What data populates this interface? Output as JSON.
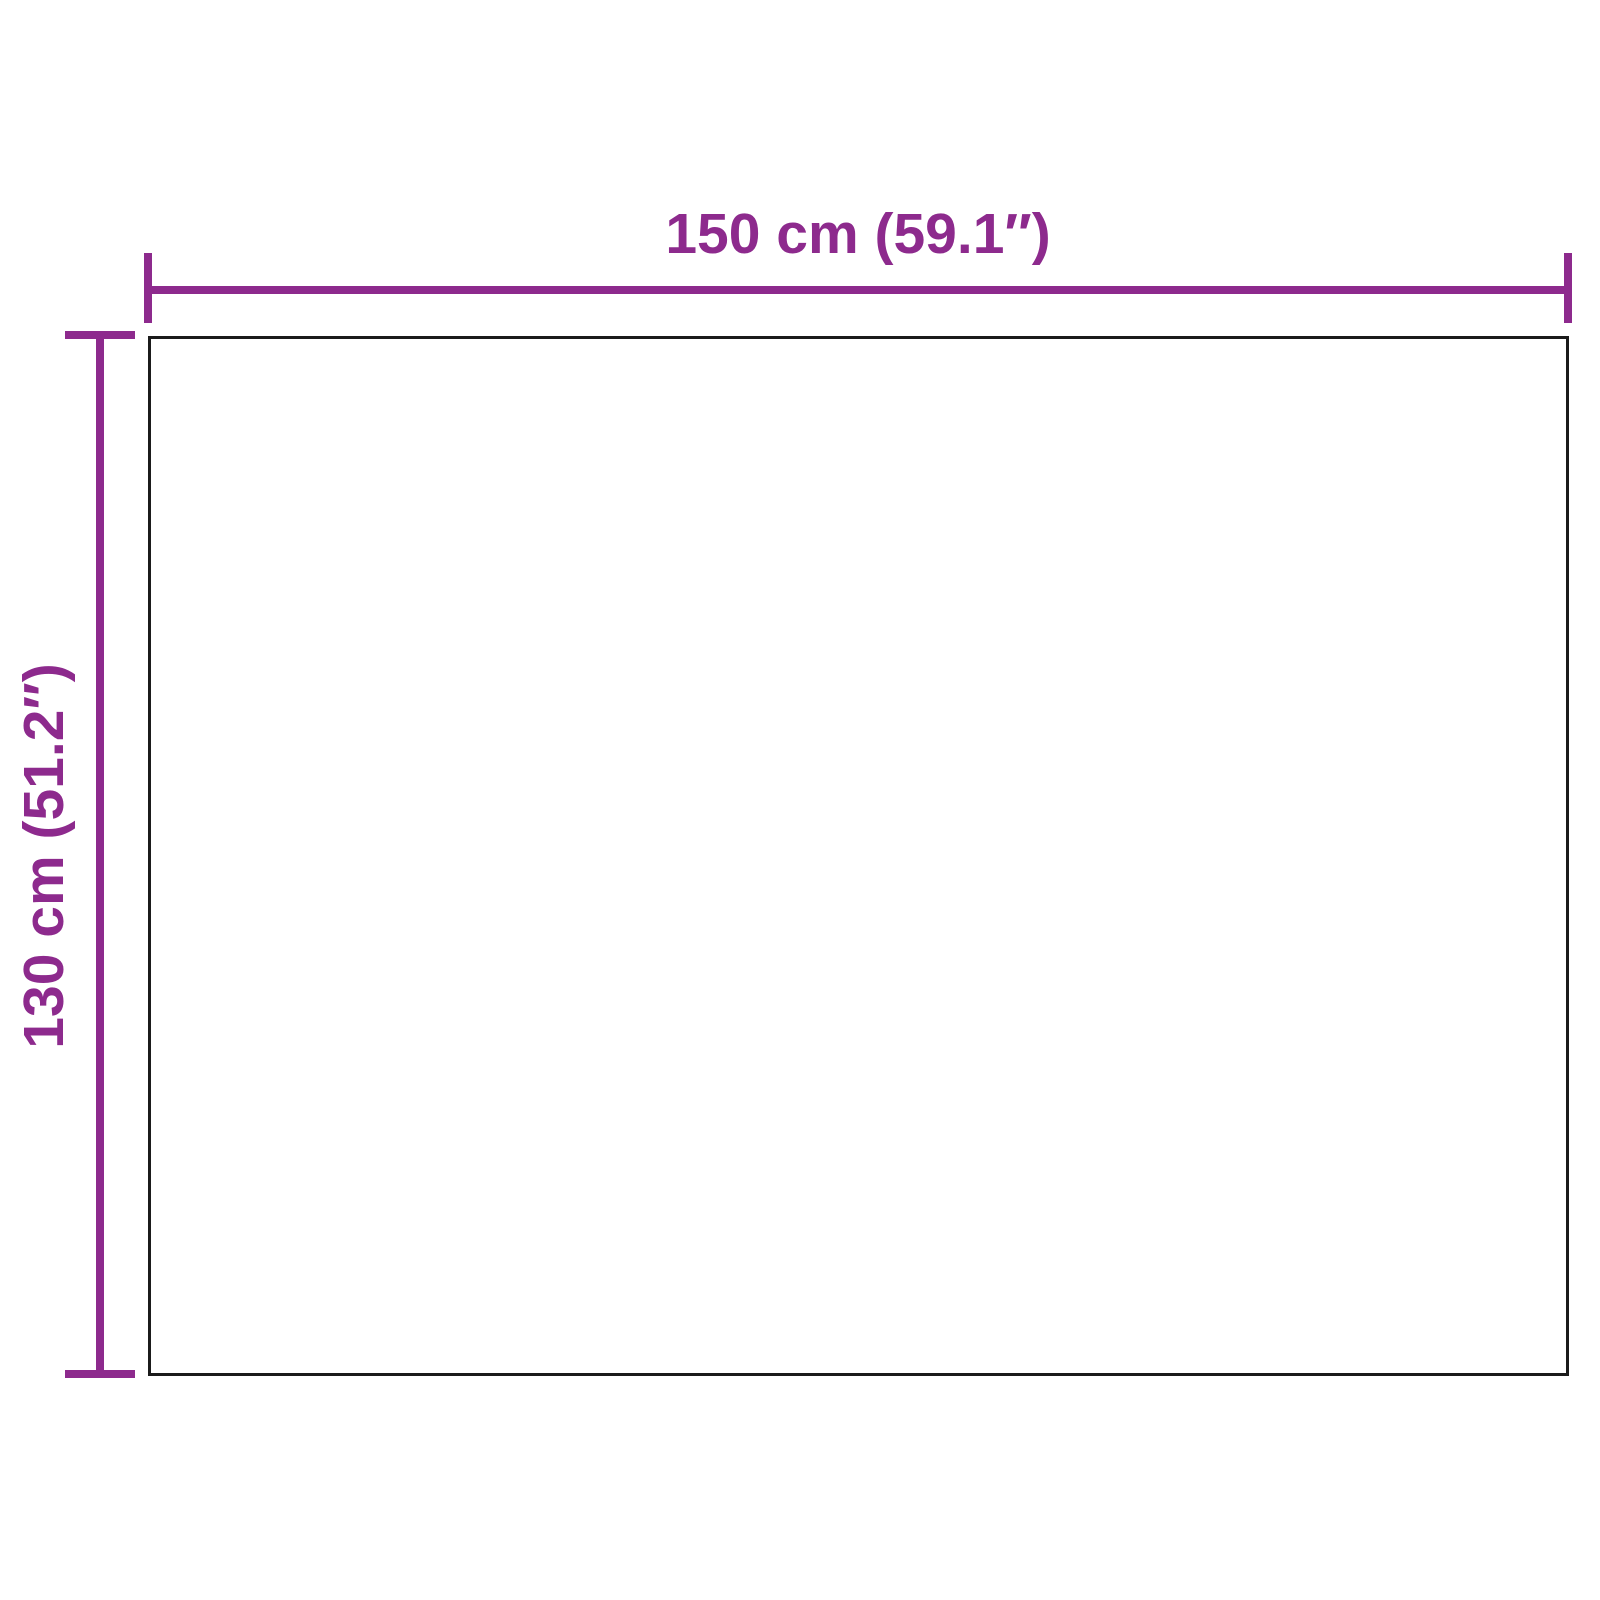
{
  "diagram": {
    "type": "product-dimension-diagram",
    "background_color": "#ffffff",
    "accent_color": "#8d2a8d",
    "outline_color": "#1b1b1b",
    "shape": "rectangle",
    "width_label": "150 cm (59.1″)",
    "height_label": "130 cm (51.2″)"
  }
}
